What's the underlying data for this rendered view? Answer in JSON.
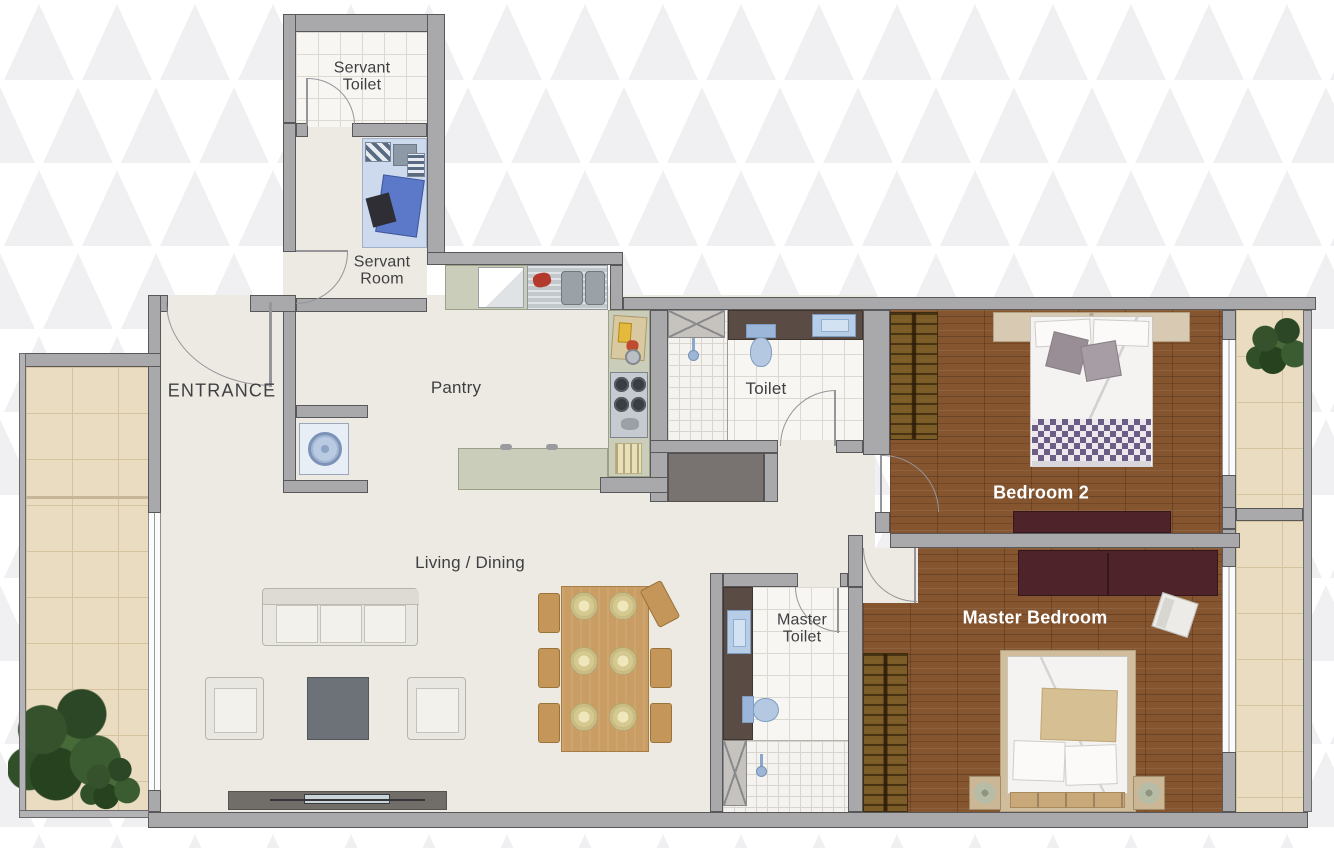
{
  "floor_plan": {
    "rooms": [
      {
        "id": "servant_toilet",
        "label": "Servant\nToilet"
      },
      {
        "id": "servant_room",
        "label": "Servant\nRoom"
      },
      {
        "id": "entrance",
        "label": "ENTRANCE"
      },
      {
        "id": "pantry",
        "label": "Pantry"
      },
      {
        "id": "toilet",
        "label": "Toilet"
      },
      {
        "id": "living_dining",
        "label": "Living / Dining"
      },
      {
        "id": "bedroom_2",
        "label": "Bedroom 2"
      },
      {
        "id": "master_toilet",
        "label": "Master\nToilet"
      },
      {
        "id": "master_bedroom",
        "label": "Master Bedroom"
      }
    ],
    "colors": {
      "wall_fill": "#a9a9ab",
      "wall_outline": "#58585a",
      "floor_cream": "#edeae3",
      "floor_wood": "#84552f",
      "tile_white": "#f7f6f3",
      "tile_balcony": "#eadcc0",
      "counter_sage": "#c9cdb9",
      "counter_dark": "#5a4c45",
      "fixture_blue": "#b7cce6",
      "dresser_maroon": "#4f232a",
      "label_dark": "#3f3f41",
      "label_light": "#ffffff",
      "background_triangle": "#f0f0f2"
    },
    "furniture": [
      "single-bed",
      "washing-machine",
      "refrigerator",
      "kitchen-sink",
      "gas-stove",
      "kitchen-counter",
      "kitchen-island",
      "sofa",
      "armchair",
      "coffee-table",
      "tv-console",
      "dining-table",
      "dining-chair",
      "shower",
      "wash-basin",
      "toilet-wc",
      "double-bed",
      "wardrobe",
      "dresser",
      "nightstand",
      "table-lamp",
      "side-chair",
      "potted-plant"
    ]
  }
}
